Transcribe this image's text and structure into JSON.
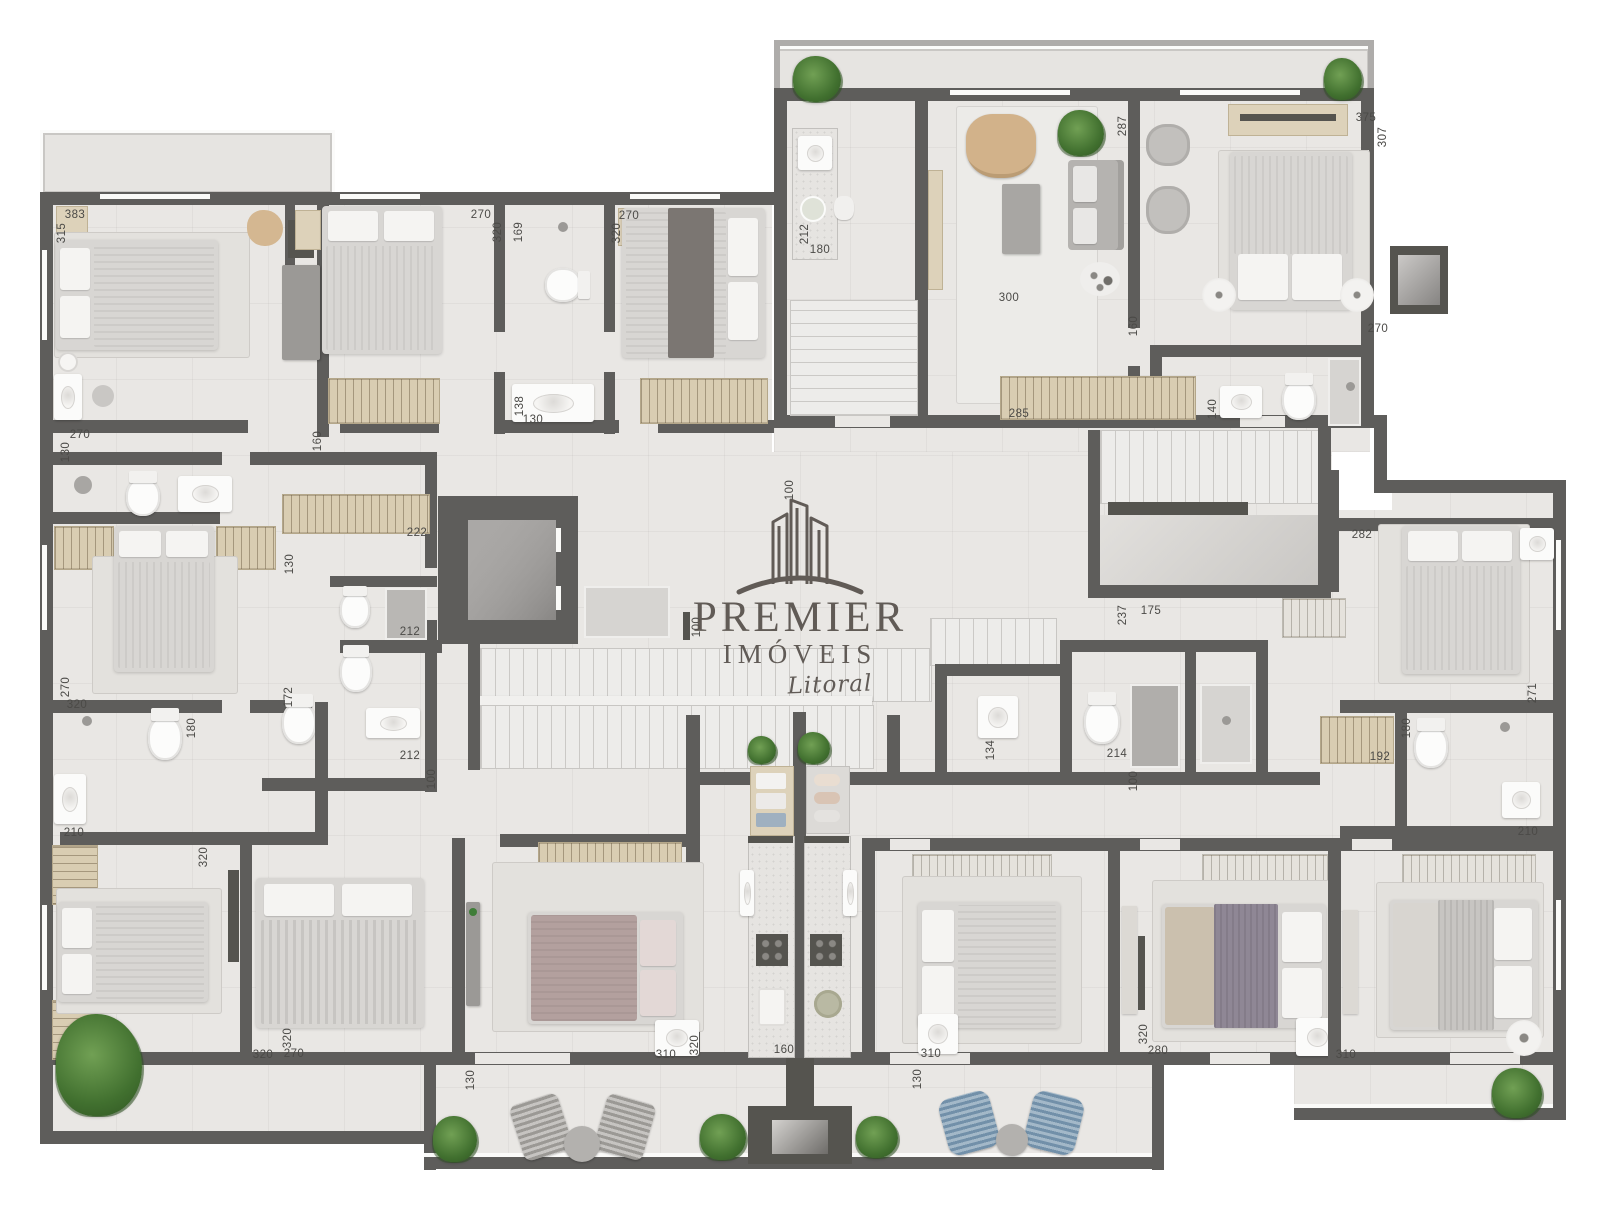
{
  "watermark": {
    "brand_top": "PREMIER",
    "brand_mid": "IMÓVEIS",
    "brand_script": "Litoral"
  },
  "colors": {
    "wall": "#5e5d5b",
    "floor": "#e9e7e4",
    "wood_wardrobe": "#d9cdb2",
    "logo": "#57514c",
    "plant_green": "#41702f",
    "label_text": "#4b4a47",
    "balcony_chair_blue": "#7290a9",
    "bed_mauve": "#b3a09e",
    "bed_purple": "#8f8795"
  },
  "dimension_labels": [
    {
      "t": "383",
      "x": 75,
      "y": 215,
      "v": false
    },
    {
      "t": "315",
      "x": 62,
      "y": 233,
      "v": true
    },
    {
      "t": "270",
      "x": 80,
      "y": 435,
      "v": false
    },
    {
      "t": "130",
      "x": 66,
      "y": 452,
      "v": true
    },
    {
      "t": "160",
      "x": 318,
      "y": 441,
      "v": true
    },
    {
      "t": "270",
      "x": 481,
      "y": 215,
      "v": false
    },
    {
      "t": "320",
      "x": 498,
      "y": 232,
      "v": true
    },
    {
      "t": "169",
      "x": 519,
      "y": 232,
      "v": true
    },
    {
      "t": "138",
      "x": 520,
      "y": 406,
      "v": true
    },
    {
      "t": "130",
      "x": 533,
      "y": 420,
      "v": false
    },
    {
      "t": "270",
      "x": 629,
      "y": 216,
      "v": false
    },
    {
      "t": "320",
      "x": 617,
      "y": 233,
      "v": true
    },
    {
      "t": "212",
      "x": 805,
      "y": 234,
      "v": true
    },
    {
      "t": "180",
      "x": 820,
      "y": 250,
      "v": false
    },
    {
      "t": "287",
      "x": 1123,
      "y": 126,
      "v": true
    },
    {
      "t": "300",
      "x": 1009,
      "y": 298,
      "v": false
    },
    {
      "t": "160",
      "x": 1134,
      "y": 326,
      "v": true
    },
    {
      "t": "375",
      "x": 1366,
      "y": 118,
      "v": false
    },
    {
      "t": "307",
      "x": 1383,
      "y": 137,
      "v": true
    },
    {
      "t": "270",
      "x": 1378,
      "y": 329,
      "v": false
    },
    {
      "t": "285",
      "x": 1019,
      "y": 414,
      "v": false
    },
    {
      "t": "140",
      "x": 1213,
      "y": 409,
      "v": true
    },
    {
      "t": "222",
      "x": 417,
      "y": 533,
      "v": false
    },
    {
      "t": "130",
      "x": 290,
      "y": 564,
      "v": true
    },
    {
      "t": "100",
      "x": 790,
      "y": 490,
      "v": true
    },
    {
      "t": "100",
      "x": 697,
      "y": 627,
      "v": true
    },
    {
      "t": "100",
      "x": 432,
      "y": 779,
      "v": true
    },
    {
      "t": "100",
      "x": 1134,
      "y": 781,
      "v": true
    },
    {
      "t": "212",
      "x": 410,
      "y": 632,
      "v": false
    },
    {
      "t": "212",
      "x": 410,
      "y": 756,
      "v": false
    },
    {
      "t": "172",
      "x": 289,
      "y": 697,
      "v": true
    },
    {
      "t": "282",
      "x": 1362,
      "y": 535,
      "v": false
    },
    {
      "t": "237",
      "x": 1123,
      "y": 615,
      "v": true
    },
    {
      "t": "175",
      "x": 1151,
      "y": 611,
      "v": false
    },
    {
      "t": "134",
      "x": 991,
      "y": 750,
      "v": true
    },
    {
      "t": "214",
      "x": 1117,
      "y": 754,
      "v": false
    },
    {
      "t": "271",
      "x": 1533,
      "y": 693,
      "v": true
    },
    {
      "t": "180",
      "x": 1407,
      "y": 728,
      "v": true
    },
    {
      "t": "192",
      "x": 1380,
      "y": 757,
      "v": false
    },
    {
      "t": "210",
      "x": 1528,
      "y": 832,
      "v": false
    },
    {
      "t": "270",
      "x": 66,
      "y": 687,
      "v": true
    },
    {
      "t": "320",
      "x": 77,
      "y": 705,
      "v": false
    },
    {
      "t": "180",
      "x": 192,
      "y": 728,
      "v": true
    },
    {
      "t": "210",
      "x": 74,
      "y": 833,
      "v": false
    },
    {
      "t": "320",
      "x": 204,
      "y": 857,
      "v": true
    },
    {
      "t": "320",
      "x": 288,
      "y": 1038,
      "v": true
    },
    {
      "t": "320",
      "x": 263,
      "y": 1055,
      "v": false
    },
    {
      "t": "270",
      "x": 294,
      "y": 1054,
      "v": false
    },
    {
      "t": "310",
      "x": 666,
      "y": 1055,
      "v": false
    },
    {
      "t": "320",
      "x": 695,
      "y": 1045,
      "v": true
    },
    {
      "t": "160",
      "x": 784,
      "y": 1050,
      "v": false
    },
    {
      "t": "130",
      "x": 471,
      "y": 1080,
      "v": true
    },
    {
      "t": "310",
      "x": 931,
      "y": 1054,
      "v": false
    },
    {
      "t": "130",
      "x": 918,
      "y": 1079,
      "v": true
    },
    {
      "t": "320",
      "x": 1144,
      "y": 1034,
      "v": true
    },
    {
      "t": "280",
      "x": 1158,
      "y": 1051,
      "v": false
    },
    {
      "t": "310",
      "x": 1346,
      "y": 1055,
      "v": false
    }
  ]
}
